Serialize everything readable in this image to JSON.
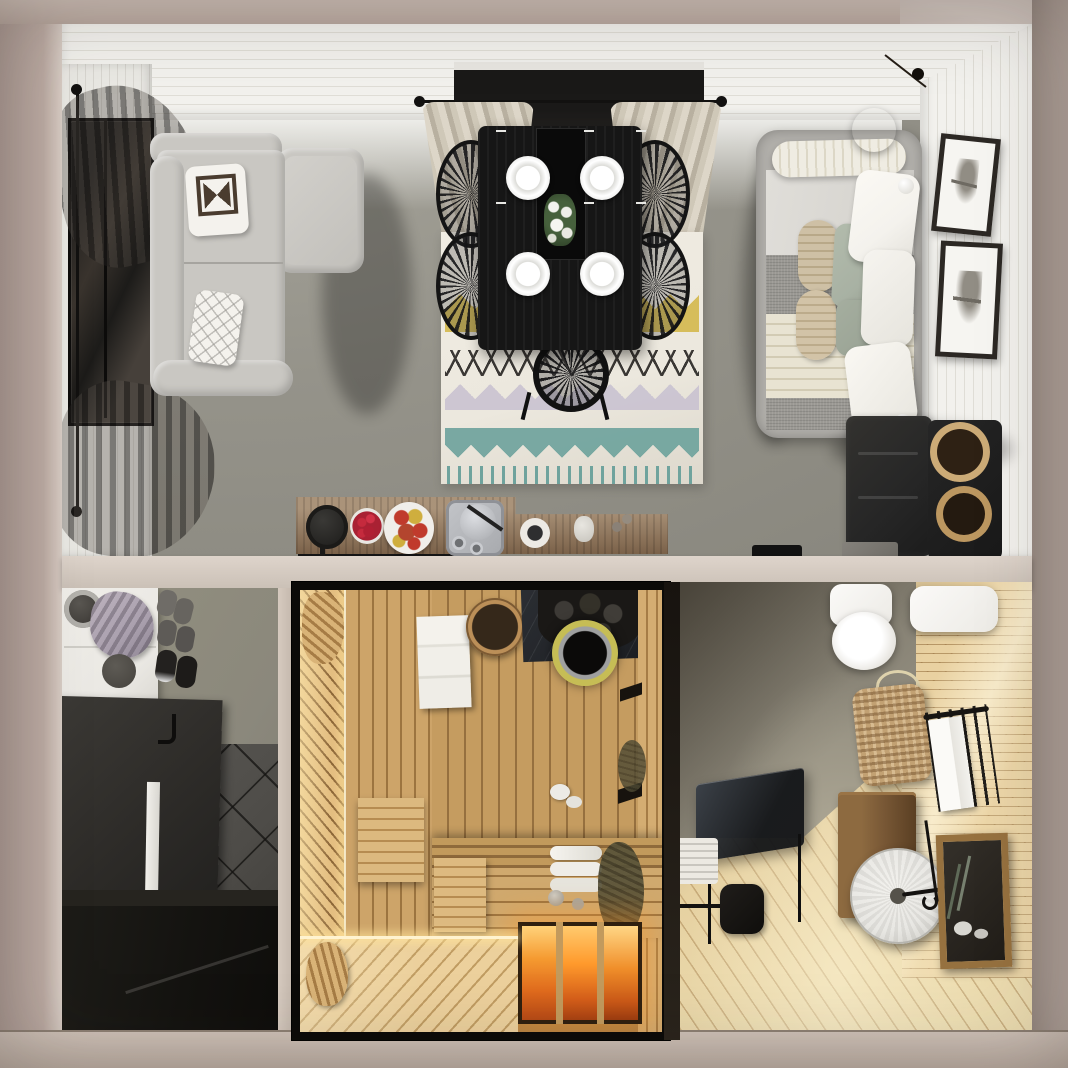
{
  "meta": {
    "title": "Top-down 3D render of a studio cabin floor plan with sauna",
    "type": "architectural-interior-render",
    "view": "top-down cutaway",
    "canvas": {
      "width": 1068,
      "height": 1068
    }
  },
  "palette": {
    "ext-base": "#b3a29b",
    "ext-light": "#c9bab1",
    "ext-dark": "#a4968e",
    "wall-white": "#f2f1ed",
    "wall-line": "#dfddd6",
    "floor-living": "#95938a",
    "floor-living-dark": "#87857c",
    "sofa": "#c9c7c2",
    "sofa-shadow": "#a6a49f",
    "table-black": "#161616",
    "chair-black": "#141414",
    "rug-cream": "#ece8de",
    "rug-black": "#2c2a27",
    "rug-yellow": "#d3b84c",
    "rug-teal": "#6fa39d",
    "rug-lilac": "#c7c0d0",
    "bed-frame": "#b1afaa",
    "bed-sheet": "#d8d6d1",
    "bed-gray": "#9a9893",
    "knit": "#e8e3d2",
    "pillow-white": "#f4f2ed",
    "pillow-sage": "#a8b1a3",
    "pillow-knit": "#cec0a5",
    "frame": "#2c2824",
    "dresser": "#262626",
    "wicker": "#c4a272",
    "counter-wood": "#977c60",
    "tray-black": "#161616",
    "apple-red": "#c03a2c",
    "berry-red": "#a92133",
    "entry-wall": "#8b887c",
    "tile": "#4e4c48",
    "void": "#141310",
    "wardrobe-white": "#eae8e3",
    "towel-lilac": "#aaa0ae",
    "sauna-light": "#cda469",
    "sauna-mid": "#d0a96e",
    "sauna-dark": "#9c7440",
    "glow-hot": "#ff9a2c",
    "glow-bright": "#ffd27a",
    "chimney-ring": "#c6bd55",
    "bath-floor": "#e6d1a1",
    "bath-wood": "#e9d1a1",
    "bath-plaster": "#8e897b",
    "vanity-wood": "#7b5a37",
    "mirror-wood": "#96713f",
    "stone-wheel": "#e8e7e3"
  },
  "rooms": [
    {
      "id": "living-dining",
      "label": "Living and dining room",
      "objects": [
        "gray sectional sofa",
        "aztec cushion",
        "diamond cushion",
        "picture window with sheer curtains",
        "black dining table",
        "four place settings",
        "flower centerpiece",
        "four spindle chairs",
        "end chair",
        "zigzag pattern rug",
        "window with beige curtains",
        "curtain rod"
      ]
    },
    {
      "id": "sleeping-nook",
      "label": "Sleeping nook",
      "objects": [
        "upholstered daybed",
        "rolled bolster",
        "gray blanket",
        "cable knit throw",
        "white pillows",
        "sage pillows",
        "knit bolster pillows",
        "wicker pendant lamp",
        "two framed tree prints",
        "black dresser",
        "two wicker baskets"
      ]
    },
    {
      "id": "kitchenette",
      "label": "Kitchenette counter",
      "objects": [
        "rustic serving board",
        "cast iron pan",
        "bowl of raspberries",
        "plate of apples",
        "tea tray with kettle",
        "coffee cup",
        "ceramic jar",
        "long black tray",
        "cooktop",
        "counter slab"
      ]
    },
    {
      "id": "entryway",
      "label": "Entryway",
      "objects": [
        "white cubby shelf",
        "hanging lilac towels",
        "round hat",
        "slippers",
        "sneakers",
        "dark storage bench",
        "white baseboard",
        "dark tiled floor",
        "under-floor void"
      ]
    },
    {
      "id": "sauna",
      "label": "Sauna",
      "objects": [
        "glass wall frame",
        "tiered wooden benches",
        "wooden headrests",
        "folded towels",
        "rolled towels",
        "wooden bucket",
        "stove with stones",
        "yellow-rimmed chimney",
        "slate board",
        "birch whisk",
        "glowing heated floor",
        "led strips",
        "glass jars",
        "towel ducks"
      ]
    },
    {
      "id": "bathroom",
      "label": "Bathroom",
      "objects": [
        "toilet",
        "floating white shelf",
        "wicker wall basket",
        "black towel rail with white towel",
        "dark glass console table",
        "white radiator",
        "black paper stand",
        "wood vanity cabinet",
        "stone wheel basin with faucet",
        "wood framed mirror",
        "diagonal plank floor"
      ]
    }
  ]
}
